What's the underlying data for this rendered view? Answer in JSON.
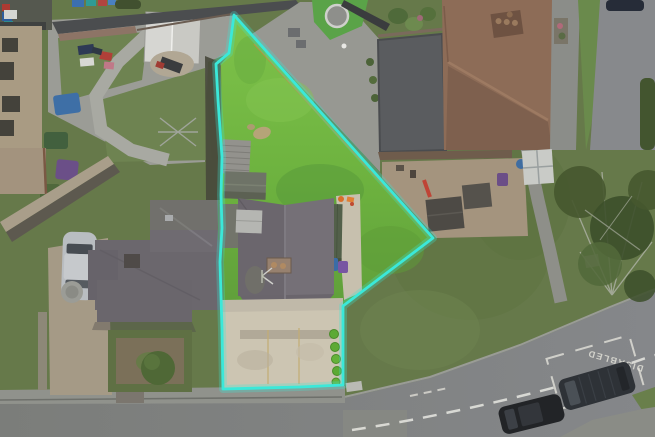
{
  "scene": {
    "kind": "aerial-drone-photo",
    "subject": "residential property with highlighted plot boundary"
  },
  "boundary": {
    "color": "#3BE8D9",
    "points": "234,15 433,238 343,306 343,385 300,387 223,389 222,330 220,262 222,228 221,195 222,157 218,100 216,64 229,53"
  },
  "road_markings": {
    "disabled_bay_label": "DISABLED",
    "color": "#E6E5DC"
  },
  "palette": {
    "subject_lawn": "#6FB93F",
    "outside_grass": "#66794A",
    "road": "#7C7E7B",
    "pavement": "#90928C",
    "subject_roof": "#6F6A71",
    "neighbor_roof_brown": "#8D6C57",
    "driveway_concrete": "#CCC5B2",
    "flat_garage_roof": "#5A5C5F"
  }
}
